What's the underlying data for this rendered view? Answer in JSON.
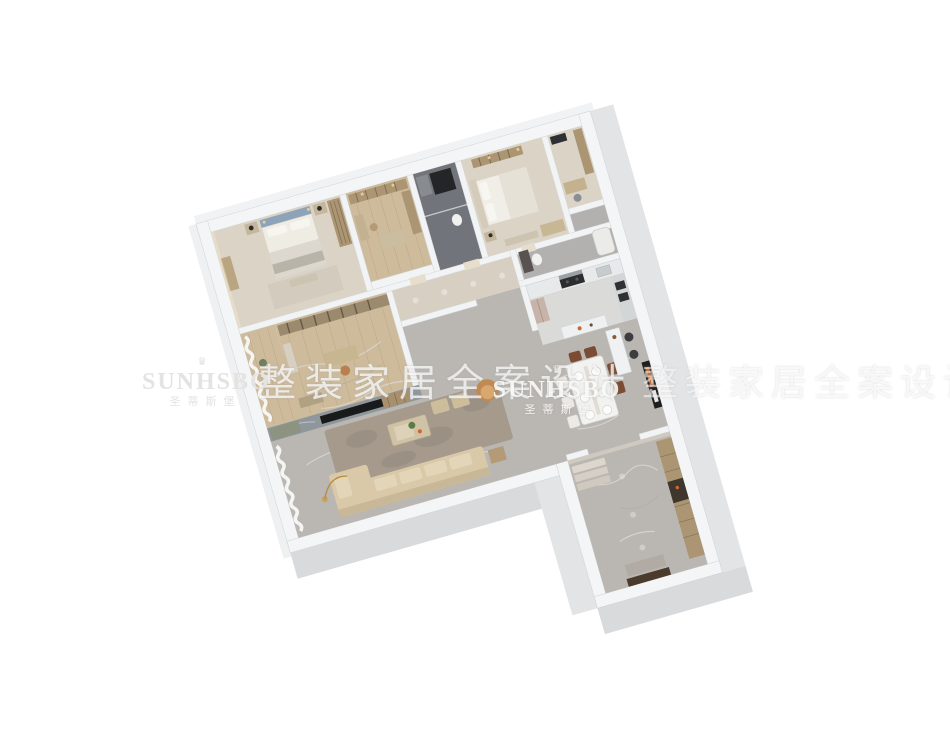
{
  "watermarks": {
    "crown_icon": "♛",
    "brand_logo": "SUNHSBO",
    "brand_chinese": "圣蒂斯堡",
    "slogan_left": "整装家居全案设计",
    "slogan_right": "整装家居全案设计"
  },
  "palette": {
    "background": "#ffffff",
    "wall_top": "#f4f5f6",
    "wall_face": "#d8dadc",
    "wall_face_light": "#e2e4e6",
    "inner_wall": "#f2f3f5",
    "floor_marble": "#bab7b2",
    "floor_carpet": "#dbd4c6",
    "floor_wood": "#cdbb9c",
    "floor_dark": "#71757b",
    "floor_tile": "#dadad8",
    "floor_stone": "#d6cfc2",
    "floor_bath": "#b3b1af",
    "rug": "#a59a8c",
    "sofa": "#d9c9a9",
    "headboard_blue": "#8ca3ba",
    "tv_black": "#191a1b",
    "tv_wall": "#8f969c",
    "accent_orange": "#c96a2a",
    "wood_cabinet": "#ab9572",
    "chair_brown": "#7b4b33",
    "stool_dark": "#3b3d40",
    "door_brown": "#4a3b2d",
    "fridge_blush": "#c7b3a7",
    "armchair_tan": "#c08a52"
  }
}
